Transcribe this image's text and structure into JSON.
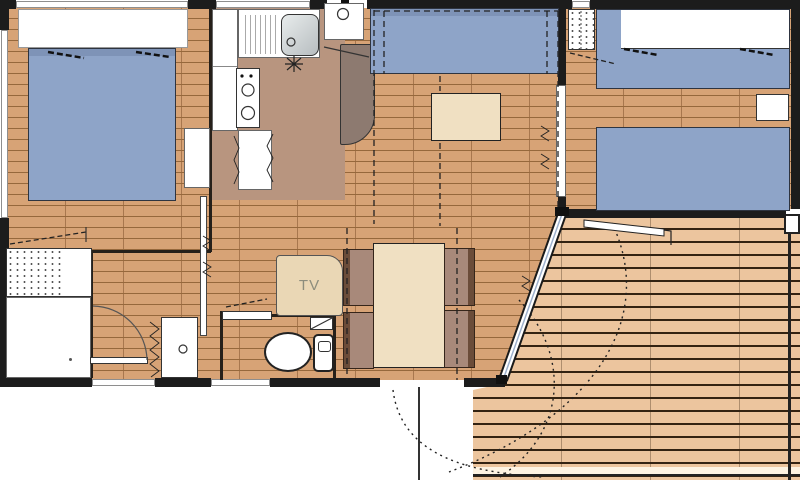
{
  "plan": {
    "labels": {
      "tv": "TV"
    },
    "colors": {
      "wall": "#1c1c1c",
      "floor": "#d7a376",
      "floor-line": "#96683c",
      "kitchen-zone": "#b8957f",
      "terrace": "#ecc59e",
      "terrace-line": "#332312",
      "bed": "#8ea4c8",
      "bed-dark": "#7e93b7",
      "beige": "#f0e0c2",
      "tv-cabinet": "#ead7b5",
      "chair": "#a8897a",
      "chair-dark": "#6b4c39",
      "taupe": "#8d7a70",
      "tv-text": "#8d8d7d",
      "glass": "#9db0cc"
    }
  }
}
